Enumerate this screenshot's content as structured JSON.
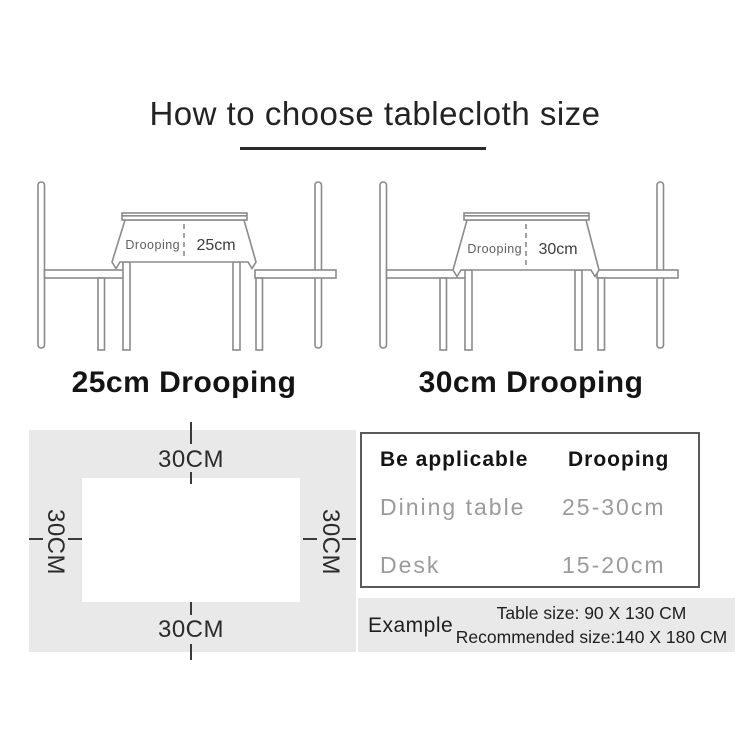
{
  "title": "How to choose tablecloth size",
  "illustrations": [
    {
      "drooping_word": "Drooping",
      "drooping_value": "25cm",
      "caption": "25cm Drooping"
    },
    {
      "drooping_word": "Drooping",
      "drooping_value": "30cm",
      "caption": "30cm Drooping"
    }
  ],
  "size_diagram": {
    "top": "30CM",
    "bottom": "30CM",
    "left": "30CM",
    "right": "30CM"
  },
  "spec_table": {
    "headers": [
      "Be applicable",
      "Drooping"
    ],
    "rows": [
      [
        "Dining table",
        "25-30cm"
      ],
      [
        "Desk",
        "15-20cm"
      ]
    ]
  },
  "example": {
    "label": "Example",
    "lines": [
      "Table size: 90 X 130 CM",
      "Recommended size:140 X 180 CM"
    ]
  },
  "colors": {
    "line_art": "#8a8a8a",
    "panel_background": "#e9e9e9",
    "text_dark": "#141414",
    "text_gray": "#9b9b9b"
  }
}
